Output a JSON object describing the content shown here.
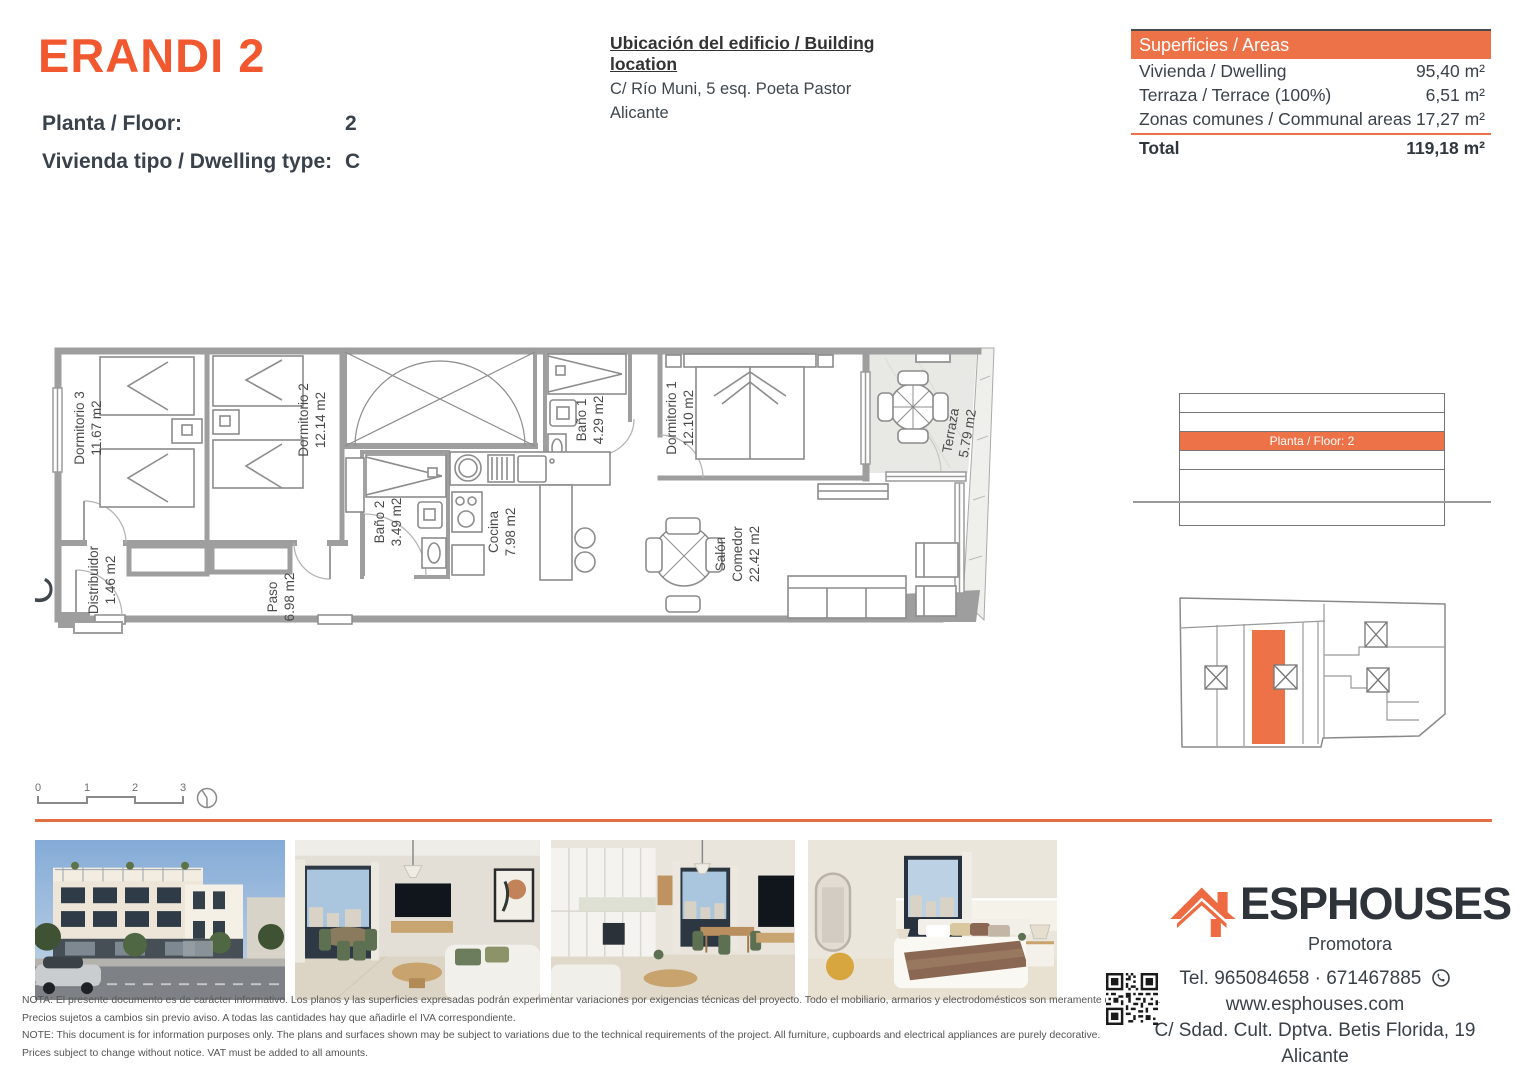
{
  "colors": {
    "accent": "#ee7247",
    "title_orange": "#f1582f",
    "wall_gray": "#9e9e9e",
    "text_dark": "#3a4147"
  },
  "header": {
    "title": "ERANDI 2",
    "floor_label": "Planta / Floor:",
    "floor_value": "2",
    "type_label": "Vivienda tipo / Dwelling type:",
    "type_value": "C",
    "location_title": "Ubicación del edificio / Building location",
    "location_line1": "C/ Río Muni, 5 esq. Poeta Pastor",
    "location_line2": "Alicante"
  },
  "areas_table": {
    "header": "Superficies / Areas",
    "rows": [
      {
        "label": "Vivienda / Dwelling",
        "value": "95,40 m²"
      },
      {
        "label": "Terraza / Terrace (100%)",
        "value": "6,51 m²"
      },
      {
        "label": "Zonas comunes / Communal areas",
        "value": "17,27 m²"
      }
    ],
    "total_label": "Total",
    "total_value": "119,18 m²"
  },
  "floor_plan": {
    "type_letter": "C",
    "rooms": [
      {
        "name": "Dormitorio 3",
        "area": "11.67 m2"
      },
      {
        "name": "Dormitorio 2",
        "area": "12.14 m2"
      },
      {
        "name": "Baño 2",
        "area": "3.49 m2"
      },
      {
        "name": "Cocina",
        "area": "7.98 m2"
      },
      {
        "name": "Baño 1",
        "area": "4.29 m2"
      },
      {
        "name": "Dormitorio 1",
        "area": "12.10 m2"
      },
      {
        "name": "Terraza",
        "area": "5.79 m2"
      },
      {
        "name": "Salón Comedor",
        "name_lines": [
          "Salón",
          "Comedor"
        ],
        "area": "22.42 m2"
      },
      {
        "name": "Distribuidor",
        "area": "1.46 m2"
      },
      {
        "name": "Paso",
        "area": "6.98 m2"
      }
    ],
    "scale_ticks": [
      "0",
      "1",
      "2",
      "3"
    ]
  },
  "elevation": {
    "highlight_label": "Planta / Floor: 2"
  },
  "footer": {
    "disclaimer_lines": [
      "NOTA: El presente documento es de carácter informativo. Los planos y las superficies expresadas podrán experimentar variaciones por exigencias técnicas del proyecto. Todo el mobiliario, armarios y electrodomésticos son meramente decorativos.",
      "Precios sujetos a cambios sin previo aviso. A todas las cantidades hay que añadirle el IVA correspondiente.",
      "NOTE: This document is for information purposes only. The plans and surfaces shown may be subject to variations due to the technical requirements of the project. All furniture, cupboards and electrical appliances are purely decorative.",
      "Prices subject to change without notice. VAT must be added to all amounts."
    ],
    "logo_text": "ESPHOUSES",
    "logo_subtitle": "Promotora",
    "phone": "Tel. 965084658 · 671467885",
    "website": "www.esphouses.com",
    "address_line1": "C/ Sdad. Cult. Dptva. Betis Florida, 19",
    "address_line2": "Alicante"
  }
}
